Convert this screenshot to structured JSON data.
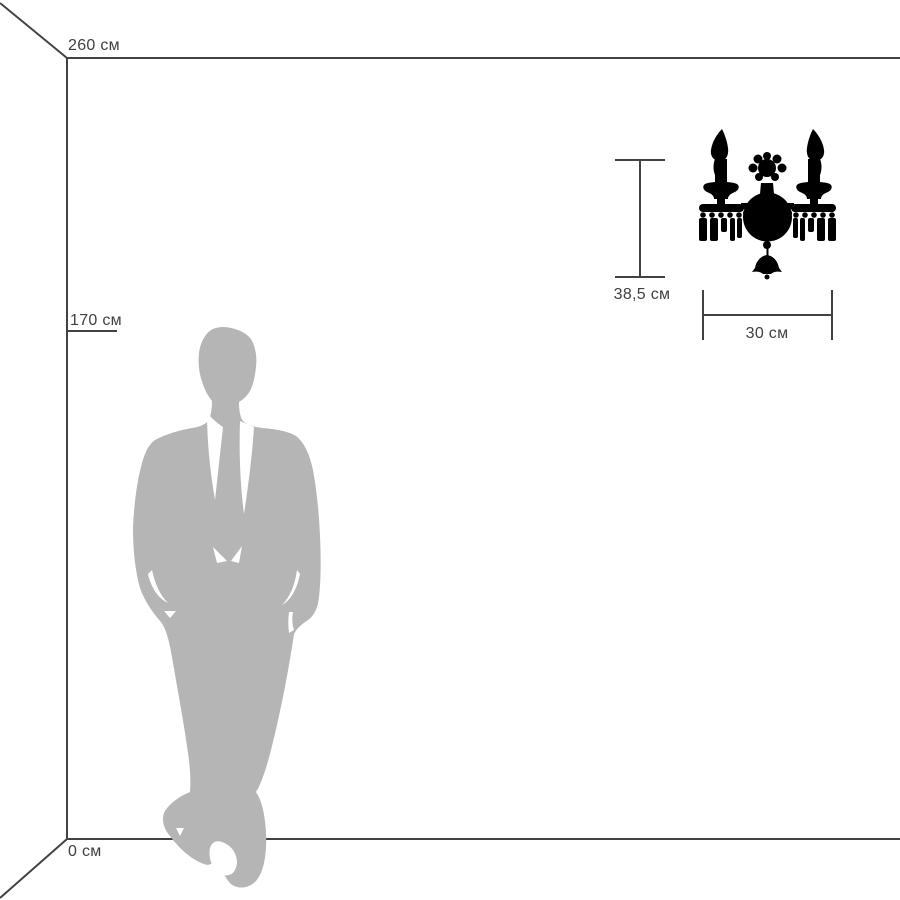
{
  "colors": {
    "background": "#ffffff",
    "outline": "#424242",
    "text": "#3f3f3f",
    "person": "#b5b5b5",
    "product": "#000000"
  },
  "labels": {
    "ceiling_height": "260 см",
    "person_height": "170 см",
    "floor": "0 см",
    "product_height": "38,5 см",
    "product_width": "30 см"
  },
  "figures": {
    "person": "man-in-suit-silhouette",
    "product": "two-candle-crystal-wall-sconce-silhouette"
  }
}
